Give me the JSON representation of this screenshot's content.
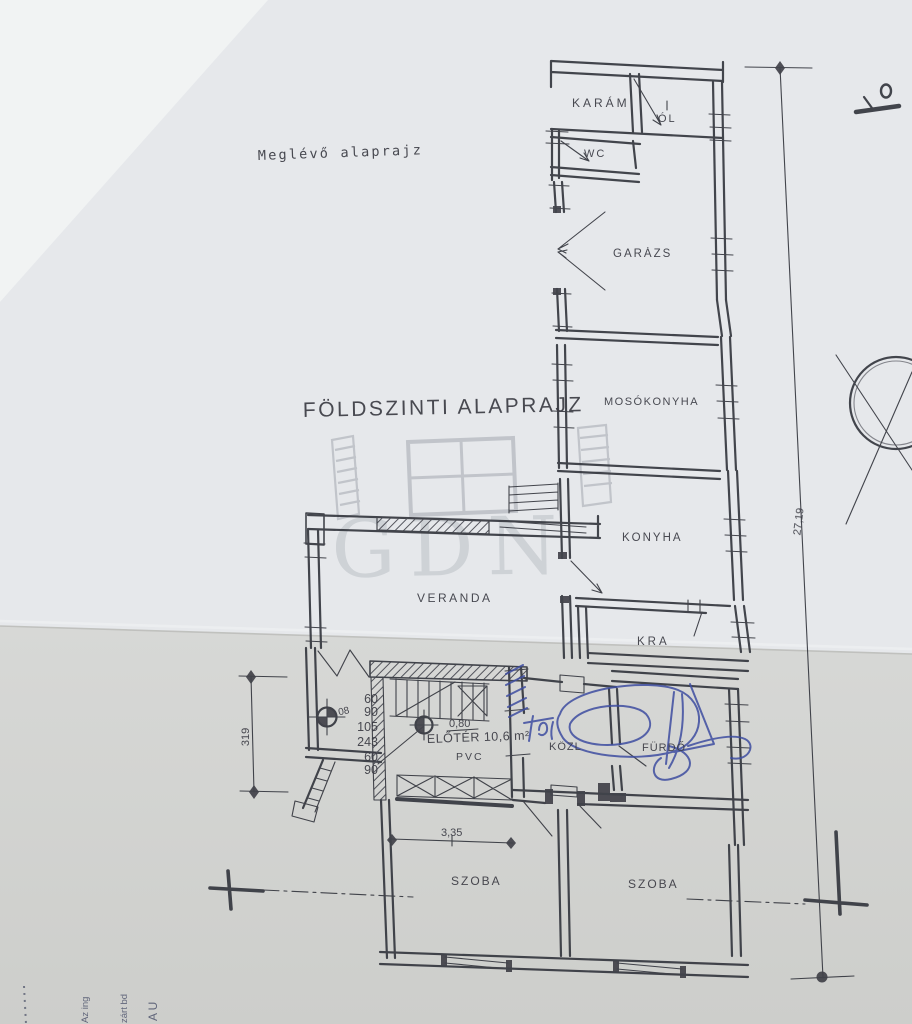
{
  "page": {
    "subtitle": "Meglévő alaprajz",
    "title": "FÖLDSZINTI ALAPRAJZ",
    "watermark": "GDN"
  },
  "rooms": {
    "karam": "KARÁM",
    "ol": "ÓL",
    "wc": "WC",
    "garazs": "GARÁZS",
    "mosokonyha": "MOSÓKONYHA",
    "konyha": "KONYHA",
    "kamra": "KRA",
    "veranda": "VERANDA",
    "eloter": "ELŐTÉR 10,6 m²",
    "eloter_floor": "PVC",
    "kozl": "KÖZL",
    "furdo": "FÜRDŐ",
    "szoba_left": "SZOBA",
    "szoba_right": "SZOBA"
  },
  "dimensions": {
    "site_height": "27,19",
    "left_vertical": "319",
    "szoba_width": "3,35",
    "door_width": "0,80",
    "small_mark": "08",
    "stair_stack": [
      "60",
      "90",
      "105",
      "243",
      "60",
      "90"
    ]
  },
  "edge_notes": {
    "note1": "Az ing",
    "note2": "zárt bd",
    "note3": "A U"
  }
}
